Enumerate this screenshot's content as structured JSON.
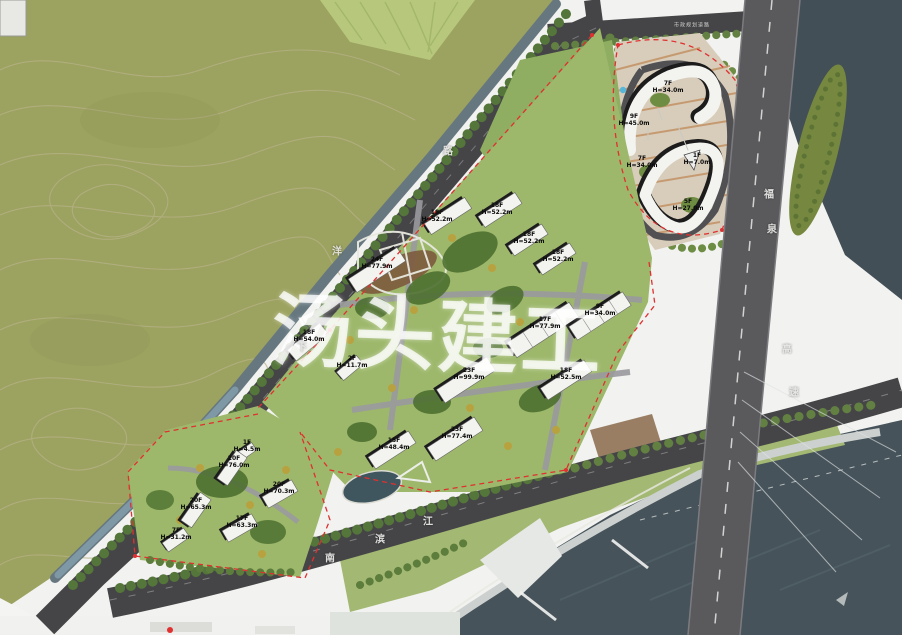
{
  "title": "residential district master plan rendering",
  "watermark": {
    "text": "汤头建工"
  },
  "roads": {
    "west": [
      "下",
      "洋",
      "路"
    ],
    "south": [
      "南",
      "滨",
      "江"
    ],
    "highway": [
      "福",
      "泉",
      "高",
      "速"
    ],
    "top_note": "市政规划道路"
  },
  "buildings": [
    {
      "floors": "7F",
      "height": "H=34.0m"
    },
    {
      "floors": "9F",
      "height": "H=45.0m"
    },
    {
      "floors": "7F",
      "height": "H=34.0m"
    },
    {
      "floors": "1F",
      "height": "H=7.0m"
    },
    {
      "floors": "5F",
      "height": "H=27.0m"
    },
    {
      "floors": "18F",
      "height": "H=52.2m"
    },
    {
      "floors": "18F",
      "height": "H=52.2m"
    },
    {
      "floors": "18F",
      "height": "H=52.2m"
    },
    {
      "floors": "18F",
      "height": "H=52.2m"
    },
    {
      "floors": "24F",
      "height": "H=77.9m"
    },
    {
      "floors": "18F",
      "height": "H=54.0m"
    },
    {
      "floors": "2F",
      "height": "H=11.7m"
    },
    {
      "floors": "17F",
      "height": "H=77.9m"
    },
    {
      "floors": "9F",
      "height": "H=34.0m"
    },
    {
      "floors": "23F",
      "height": "H=99.9m"
    },
    {
      "floors": "18F",
      "height": "H=52.5m"
    },
    {
      "floors": "23F",
      "height": "H=77.4m"
    },
    {
      "floors": "15F",
      "height": "H=48.4m"
    },
    {
      "floors": "1F",
      "height": "H=4.5m"
    },
    {
      "floors": "20F",
      "height": "H=76.0m"
    },
    {
      "floors": "20F",
      "height": "H=65.3m"
    },
    {
      "floors": "20F",
      "height": "H=70.3m"
    },
    {
      "floors": "17F",
      "height": "H=63.3m"
    },
    {
      "floors": "7F",
      "height": "H=31.2m"
    }
  ],
  "colors": {
    "field": "#9ca25f",
    "contour": "#b7b289",
    "lawn": "#9db86b",
    "tree_dark": "#4e7031",
    "road": "#454547",
    "highway": "#5a5a5d",
    "water": "#46535a",
    "building": "#f3f3ef",
    "shadow": "#1c1c1c",
    "boundary_red": "#e03030",
    "parking_stripe": "#c08a58"
  }
}
